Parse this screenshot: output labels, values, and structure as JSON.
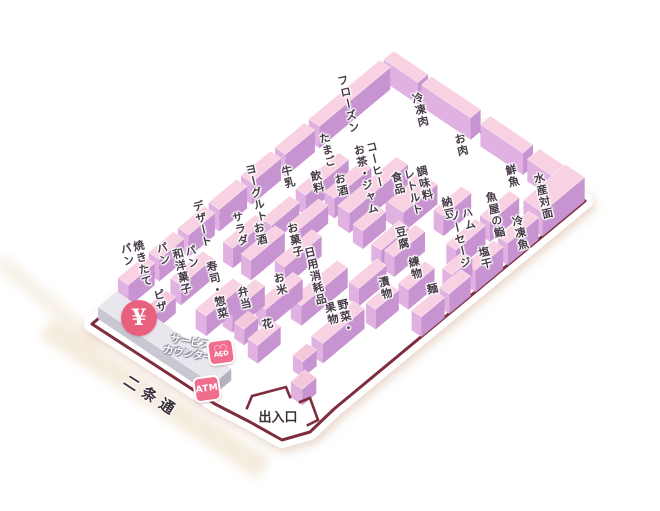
{
  "map": {
    "colors": {
      "border": "#7e2d3e",
      "floor": "#ffffff",
      "block_top": "#f8d2e2",
      "block_top_alt": "#f4c8da",
      "block_sw_face": "#e1b1e2",
      "block_se_face": "#c793d0",
      "counter_top": "#e8e7ed",
      "counter_sw_face": "#c9c8d2",
      "counter_se_face": "#b3b2bd",
      "badge_pink": "#f06d8e",
      "yen_circle_pink": "#e9607f",
      "street_beige": "#ecdcc2"
    },
    "sections": [
      {
        "id": "frozen",
        "label": "フローズン"
      },
      {
        "id": "eggs",
        "label": "たまご"
      },
      {
        "id": "milk",
        "label": "牛乳"
      },
      {
        "id": "yogurt",
        "label": "ヨーグルト"
      },
      {
        "id": "dessert",
        "label": "デザート"
      },
      {
        "id": "bread",
        "label": "パン"
      },
      {
        "id": "baked-bread",
        "label": "焼きたて\nパン"
      },
      {
        "id": "frozen-meat",
        "label": "冷凍肉"
      },
      {
        "id": "meat",
        "label": "お肉"
      },
      {
        "id": "fresh-fish",
        "label": "鮮魚"
      },
      {
        "id": "seafood-counter",
        "label": "水産対面"
      },
      {
        "id": "frozen-fish",
        "label": "冷凍魚"
      },
      {
        "id": "salted-dried",
        "label": "塩干"
      },
      {
        "id": "beverages",
        "label": "飲料"
      },
      {
        "id": "sake",
        "label": "お酒"
      },
      {
        "id": "coffee-tea-jam",
        "label": "コーヒー\nお茶・ジャム"
      },
      {
        "id": "seasoning-retort",
        "label": "調味料\nレトルト\n食品"
      },
      {
        "id": "natto",
        "label": "納豆"
      },
      {
        "id": "fishmonger-sushi",
        "label": "魚屋の鮨"
      },
      {
        "id": "ham-sausage",
        "label": "ハム\nソーセージ"
      },
      {
        "id": "tofu",
        "label": "豆腐"
      },
      {
        "id": "neri",
        "label": "練物"
      },
      {
        "id": "noodles",
        "label": "麺"
      },
      {
        "id": "pickles",
        "label": "漬物"
      },
      {
        "id": "vegetables-fruits",
        "label": "野菜・\n果物"
      },
      {
        "id": "daily-consumables",
        "label": "日用消耗品"
      },
      {
        "id": "rice",
        "label": "お米"
      },
      {
        "id": "flowers",
        "label": "花"
      },
      {
        "id": "bento",
        "label": "弁当"
      },
      {
        "id": "sweets",
        "label": "お菓子"
      },
      {
        "id": "sake-2",
        "label": "お酒"
      },
      {
        "id": "salad",
        "label": "サラダ"
      },
      {
        "id": "sushi-deli",
        "label": "寿司・惣菜"
      },
      {
        "id": "bread-confectionery",
        "label": "パン\n和洋菓子"
      },
      {
        "id": "pizza",
        "label": "ピザ"
      }
    ],
    "facilities": {
      "yen_symbol": "¥",
      "service_counter": "サービス\nカウンター",
      "aed": "AED",
      "atm": "ATM",
      "entrance": "出入口",
      "street": "二条通"
    }
  }
}
